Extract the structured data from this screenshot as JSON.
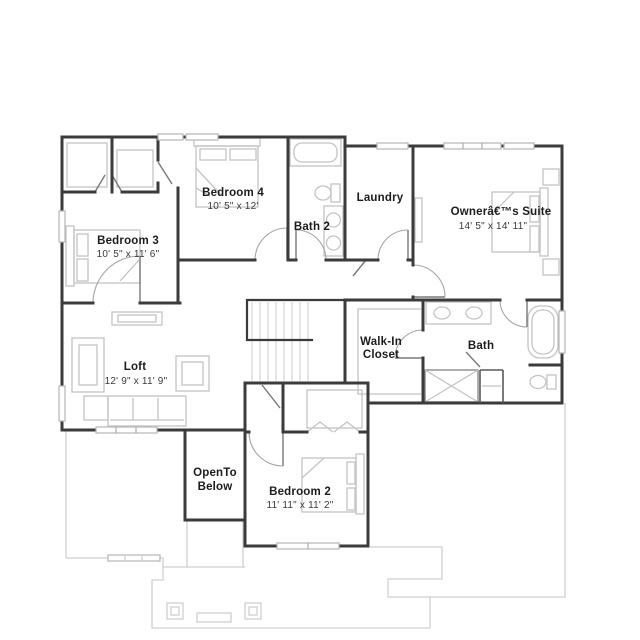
{
  "plan": {
    "rooms": {
      "bedroom4": {
        "name": "Bedroom 4",
        "dims": "10' 5\" x 12'"
      },
      "bedroom3": {
        "name": "Bedroom 3",
        "dims": "10' 5\" x 11' 6\""
      },
      "bath2": {
        "name": "Bath 2"
      },
      "laundry": {
        "name": "Laundry"
      },
      "owners_suite": {
        "name": "Ownerâ€™s Suite",
        "dims": "14' 5\" x 14' 11\""
      },
      "walk_in_closet": {
        "name_line1": "Walk-In",
        "name_line2": "Closet"
      },
      "bath": {
        "name": "Bath"
      },
      "loft": {
        "name": "Loft",
        "dims": "12' 9\" x 11' 9\""
      },
      "open_to_below": {
        "name_line1": "OpenTo",
        "name_line2": "Below"
      },
      "bedroom2": {
        "name": "Bedroom 2",
        "dims": "11' 11\" x 11' 2\""
      }
    },
    "colors": {
      "wall": "#3b3b3b",
      "fixture": "#c4c4c4",
      "lower_floor": "#cfcfcf",
      "text": "#1c1c1c"
    }
  }
}
